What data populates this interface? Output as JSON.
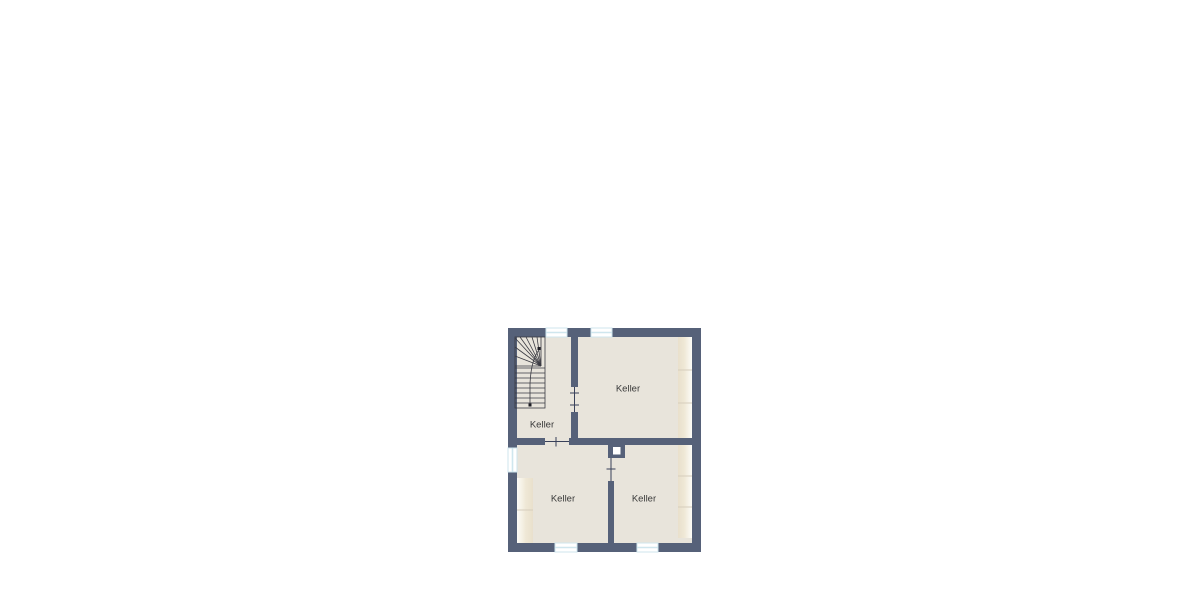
{
  "plan": {
    "rooms": [
      {
        "id": "stair-room",
        "label": "Keller"
      },
      {
        "id": "top-right",
        "label": "Keller"
      },
      {
        "id": "bottom-left",
        "label": "Keller"
      },
      {
        "id": "bottom-right",
        "label": "Keller"
      }
    ],
    "colors": {
      "wall": "#566179",
      "floor": "#e8e4db",
      "window_frame": "#cfe6ee",
      "shelf": "#ede5d3",
      "shelf_divider": "#d6cdbc",
      "opening_line": "#39415a",
      "stair_line": "#3a3a42",
      "label_text": "#3a3a3a",
      "page_background": "#ffffff"
    }
  }
}
